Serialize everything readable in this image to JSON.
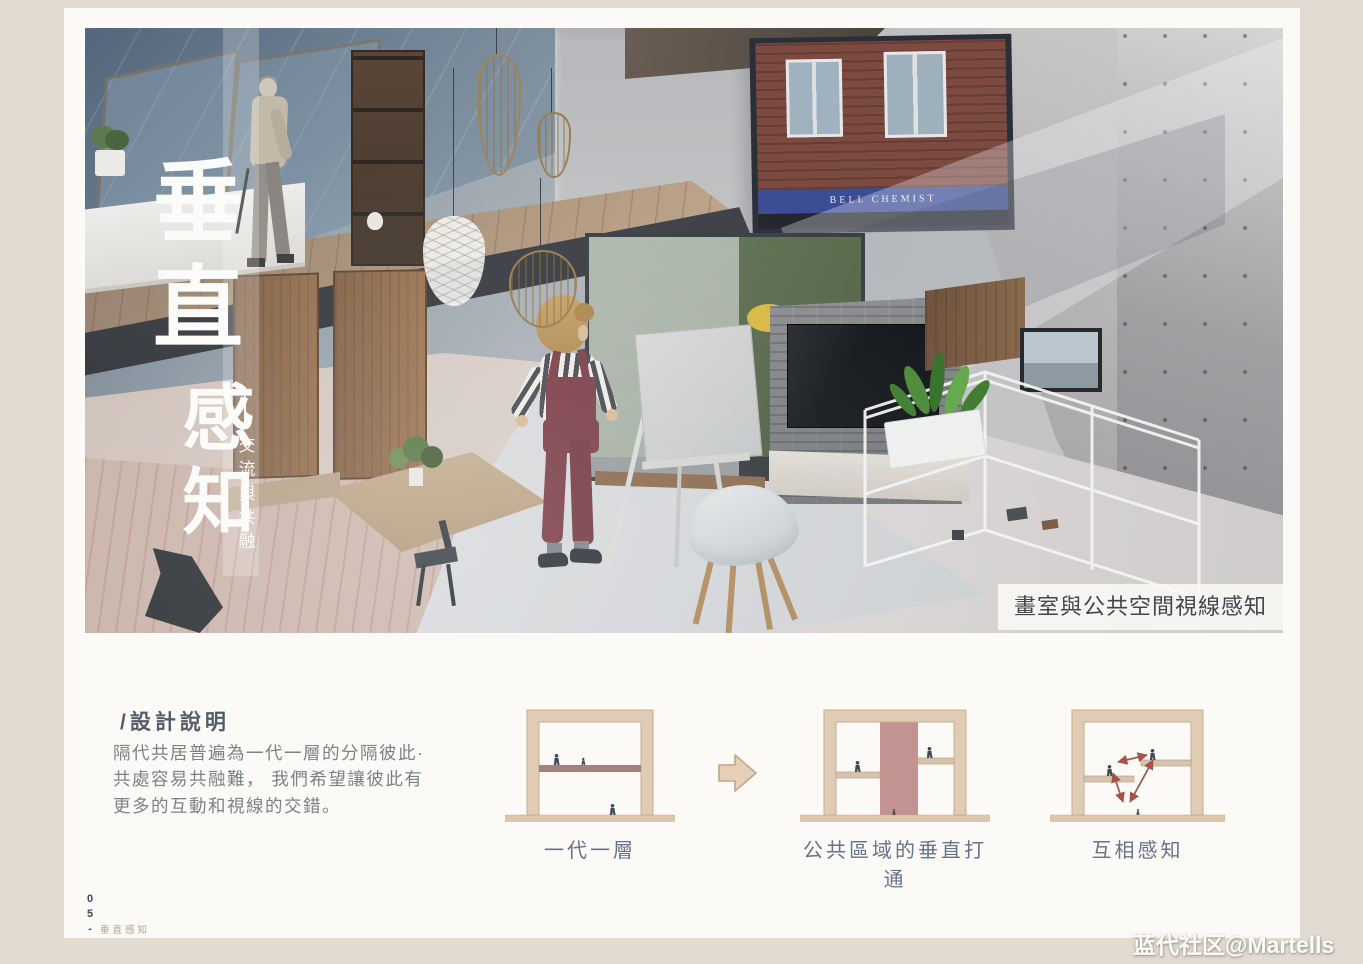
{
  "hero": {
    "title_top": "垂直",
    "title_bottom": "感知",
    "subtitle": "交流與共融",
    "caption": "畫室與公共空間視線感知",
    "window_sign": "BELL CHEMIST"
  },
  "description": {
    "heading": "/設計說明",
    "lines": [
      "隔代共居普遍為一代一層的分隔彼此·",
      "共處容易共融難， 我們希望讓彼此有",
      "更多的互動和視線的交錯。"
    ]
  },
  "diagrams": {
    "items": [
      {
        "label": "一代一層"
      },
      {
        "label": "公共區域的垂直打通"
      },
      {
        "label": "互相感知"
      }
    ]
  },
  "footer": {
    "page_number": "05-",
    "page_caption": "垂直感知"
  },
  "watermark": {
    "text": "蓝代社区@Martells"
  },
  "palette": {
    "page_bg": "#e3dbd2",
    "board_bg": "#fcfaf6",
    "title_white": "#fbfbf9",
    "label_blue": "#64748a",
    "heading_text": "#515d69",
    "body_text": "#7c8187",
    "diagram_wall": "#e0cbb5",
    "diagram_wall_border": "#c7ac8e",
    "diagram_slab": "#a5817e",
    "diagram_void": "#c29391",
    "diagram_ground": "#dcc6ae",
    "diagram_figure": "#3d4a57",
    "diagram_arrow": "#a4524b",
    "girl_overalls": "#7b3e48",
    "brick": "#7c4a41",
    "sign_blue": "#3c4d95"
  }
}
